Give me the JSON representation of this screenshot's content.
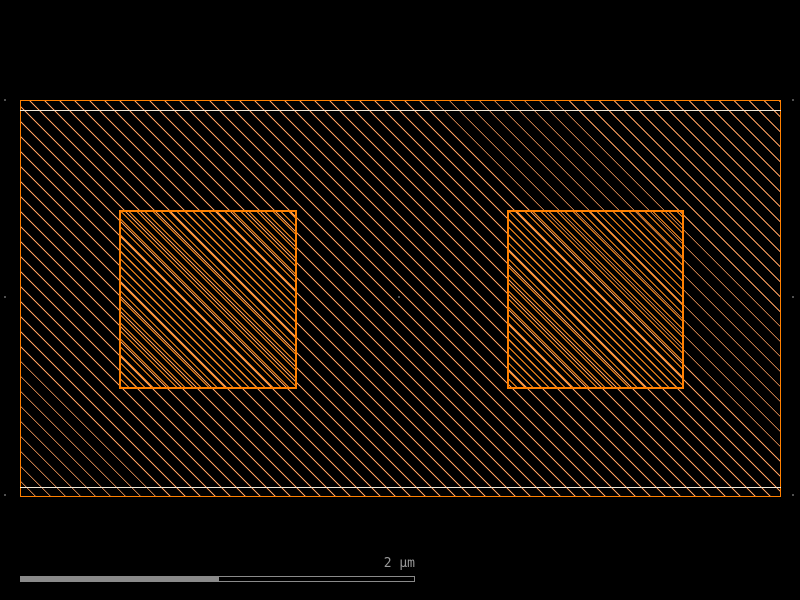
{
  "colors": {
    "background": "#000000",
    "shape_frame": "#ff8000",
    "field_hatch": "#ffa060",
    "dense_hatch": "#ff8c1a",
    "band_frame": "#f0e8d8",
    "scalebar": "#8a8a8a",
    "scalebar_text": "#9a9a9a",
    "grid_dot": "#505050"
  },
  "viewport": {
    "width": 800,
    "height": 600,
    "outer_region": {
      "x": 20,
      "y": 100,
      "w": 761,
      "h": 397
    },
    "inner_band": {
      "x": 20,
      "y": 110,
      "w": 761,
      "h": 378
    },
    "squares": [
      {
        "x": 119,
        "y": 210,
        "w": 178,
        "h": 179
      },
      {
        "x": 507,
        "y": 210,
        "w": 177,
        "h": 179
      }
    ],
    "grid_dots": [
      [
        5,
        100
      ],
      [
        793,
        100
      ],
      [
        5,
        297
      ],
      [
        399,
        297
      ],
      [
        793,
        297
      ],
      [
        5,
        495
      ],
      [
        793,
        495
      ]
    ]
  },
  "scale_bar": {
    "label": "2 µm",
    "solid": {
      "x": 20,
      "y": 576,
      "w": 198,
      "h": 6
    },
    "outline": {
      "x": 218,
      "y": 576,
      "w": 197,
      "h": 6
    }
  }
}
